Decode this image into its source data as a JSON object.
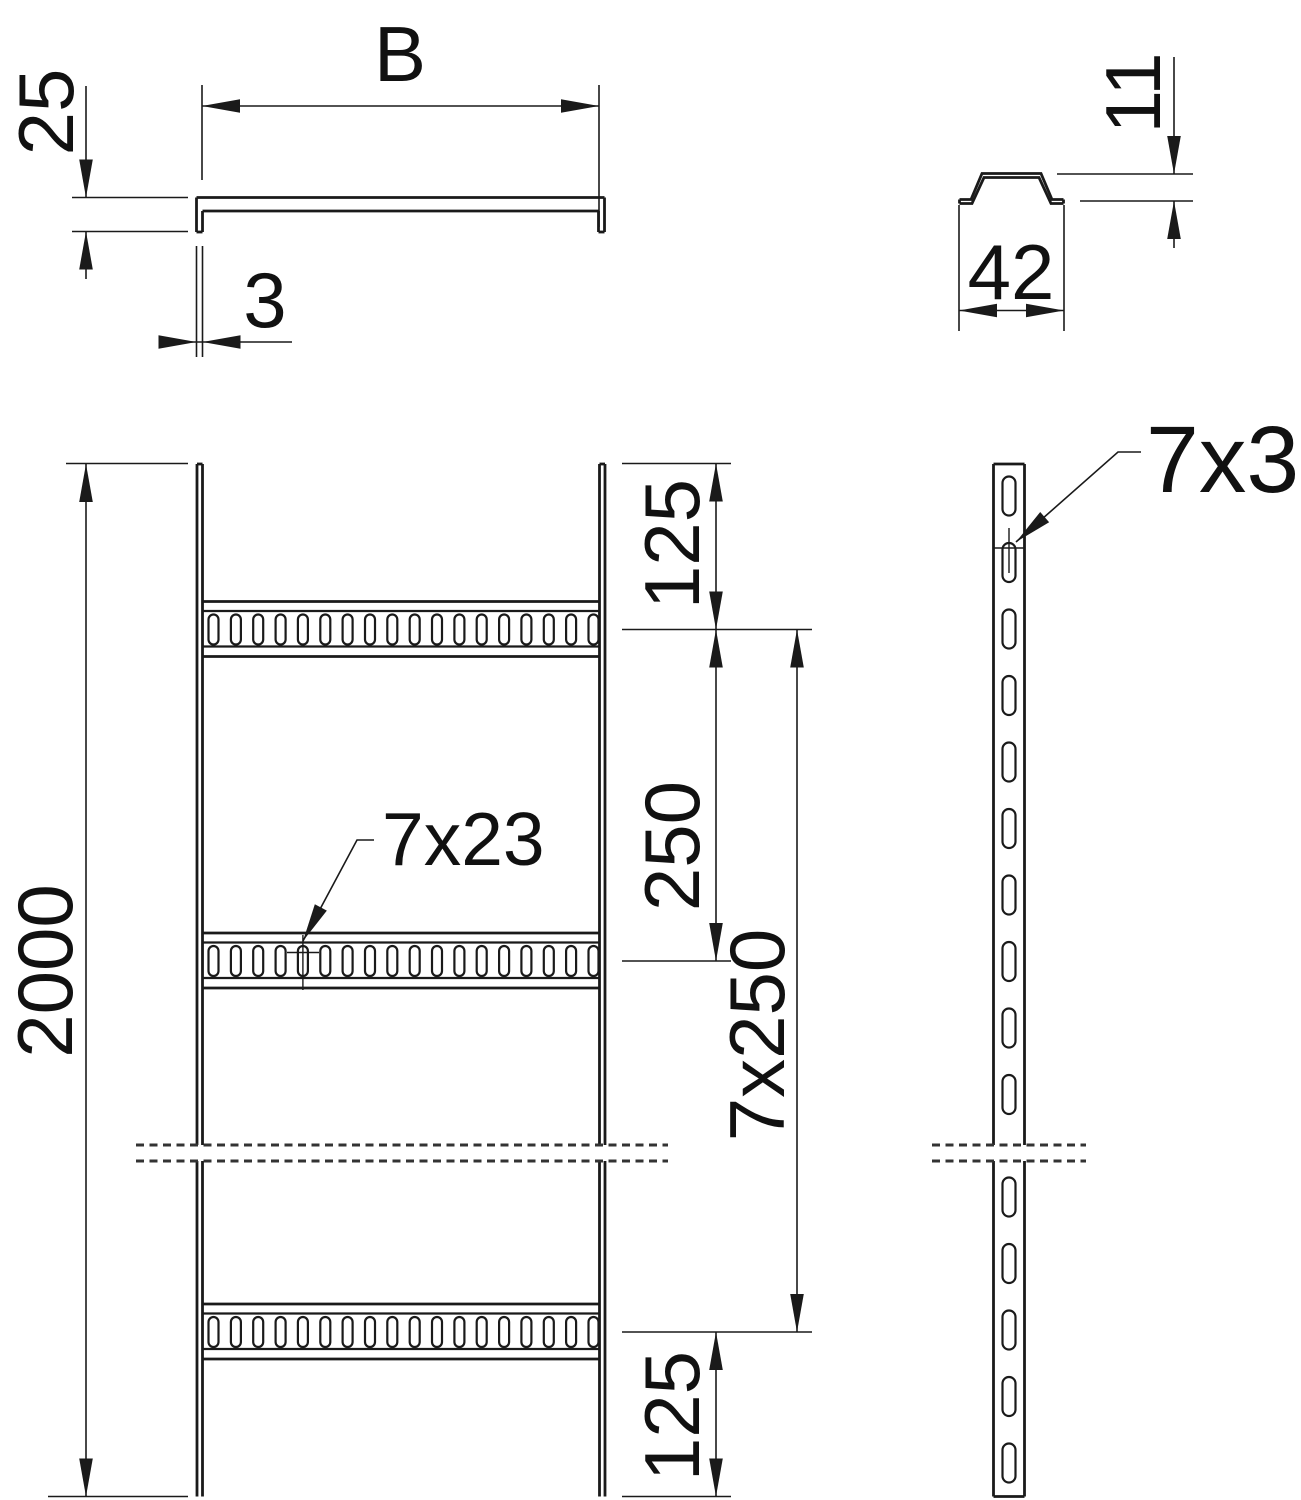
{
  "drawing": {
    "kind": "cable-ladder technical drawing",
    "background": "#ffffff",
    "line_color": "#1a1a1a",
    "views": {
      "top_section": {
        "width": "B",
        "side_height": "25",
        "thickness": "3"
      },
      "rung_section": {
        "height": "11",
        "width": "42"
      },
      "front_view": {
        "total_length": "2000",
        "top_offset": "125",
        "rung_spacing": "250",
        "rung_spacing_total": "7x250",
        "bottom_offset": "125",
        "rung_slot_size": "7x23"
      },
      "side_view": {
        "rail_slot_size": "7x30"
      }
    }
  }
}
